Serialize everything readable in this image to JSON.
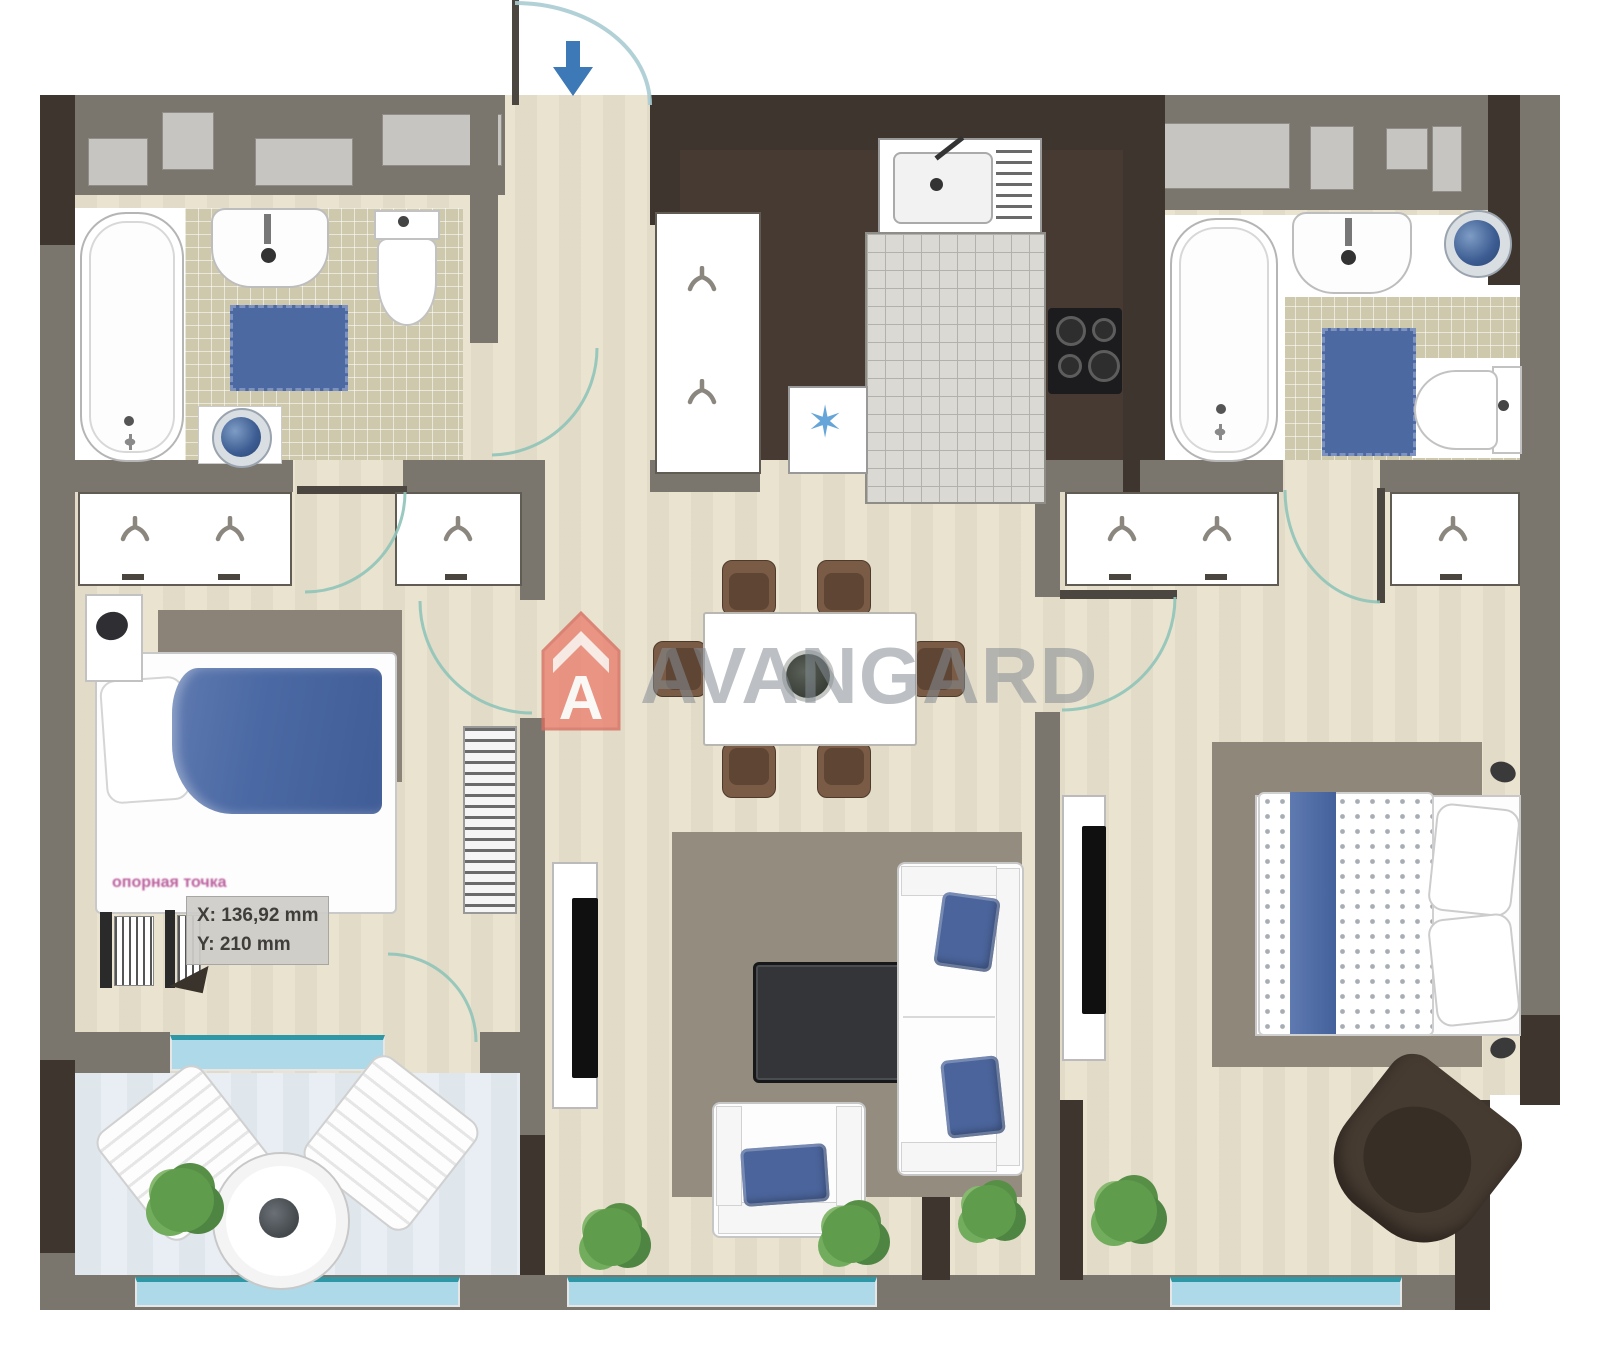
{
  "watermark": {
    "brand": "AVANGARD",
    "logo_letter": "A"
  },
  "tooltip": {
    "x_readout": "X: 136,92 mm",
    "y_readout": "Y: 210 mm"
  },
  "annotation": {
    "pink_note": "опорная точка"
  },
  "entrance": {
    "direction": "down"
  },
  "icons": {
    "entry_arrow": "arrow-down",
    "coat_hook": "hanger-hook",
    "snowflake": "six-point-star",
    "logo": "house-with-letter-A"
  },
  "colors": {
    "wall_gray": "#7a756d",
    "wall_dark": "#3e352e",
    "floor_beige": "#eae3d0",
    "bathroom_tile": "#cec8ad",
    "kitchen_floor": "#473a33",
    "accent_blue": "#4c69a2",
    "window_teal": "#2e98a6",
    "balcony_floor": "#e8eef3",
    "door_arc": "#8fc3b8",
    "logo_red": "#ea8172",
    "watermark_gray": "#858c94",
    "plant_green": "#5f9c4c",
    "chair_brown": "#7a5b45",
    "armchair_dark": "#463b31"
  }
}
